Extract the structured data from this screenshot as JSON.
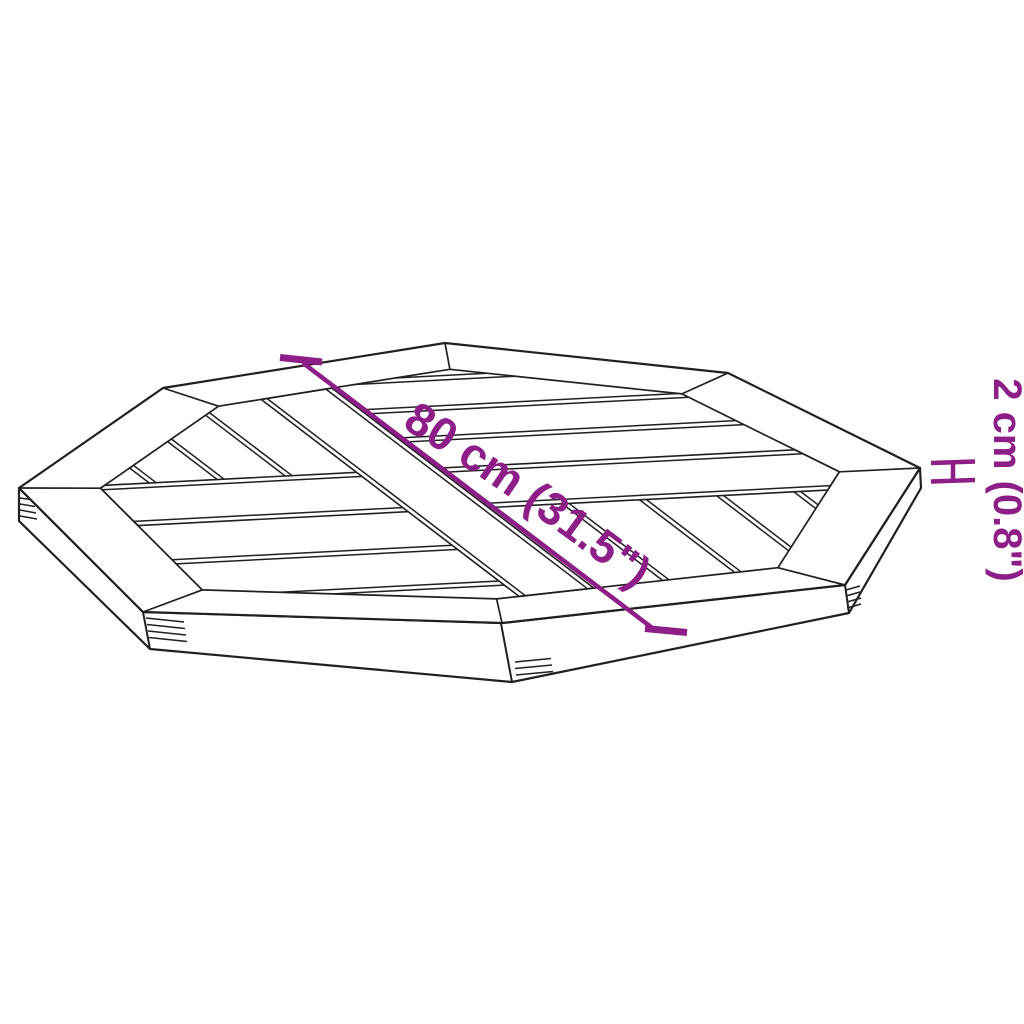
{
  "image": {
    "kind": "product-dimension-diagram",
    "subject": "octagonal-parquet-table-top"
  },
  "labels": {
    "width": "80 cm (31.5\")",
    "thickness": "2 cm (0.8\")"
  },
  "icons": {
    "thickness_marker": "h-bracket-extent-marker"
  },
  "colors": {
    "annotation": "#8d1d87",
    "line": "#221f22",
    "background": "#ffffff"
  }
}
